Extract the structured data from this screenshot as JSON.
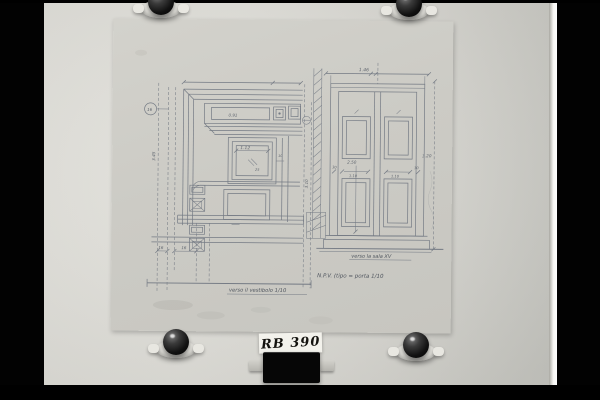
{
  "photo": {
    "catalog_label": "RB 390"
  },
  "colors": {
    "background": "#000000",
    "board": "#dfded8",
    "paper": "#cecdc7",
    "pencil": "#747a84",
    "label_bg": "#f3f2ec",
    "film_holder": "#060606"
  },
  "pins": {
    "icon": "magnet-pin-icon",
    "count": 4
  },
  "drawings": {
    "left": {
      "caption": "verso il vestibolo 1/10",
      "dims": {
        "panel_width": "1.12",
        "frieze": "0.91",
        "jamb_a": "16",
        "jamb_b": "16",
        "detail_mark": "16",
        "height_right": "3.10",
        "chain": "3.45",
        "molding": "25",
        "tick": "10"
      }
    },
    "right": {
      "caption": "verso la sala XV",
      "note": "N.P.V. (tipo = porta 1/10",
      "dims": {
        "overall_width": "1.46",
        "overall_height": "3.20",
        "leaf_height": "2.50",
        "stile_left": "30",
        "stile_right": "30",
        "panel_left": "1.10",
        "panel_right": "1.10"
      }
    }
  }
}
